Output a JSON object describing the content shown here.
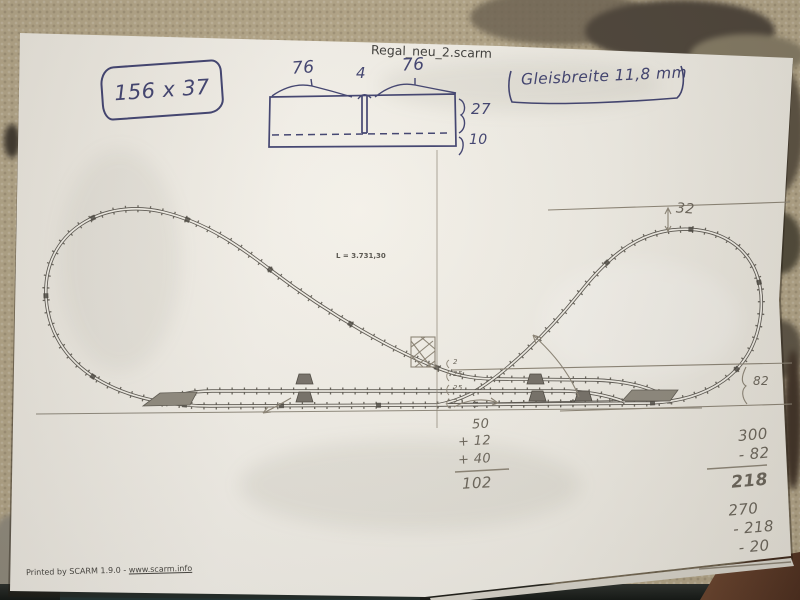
{
  "palette": {
    "ink": "#3e4170",
    "pencil": "#6b665c",
    "paper": "#f1efe8",
    "carpet": "#b2a588"
  },
  "paper": {
    "title": "Regal_neu_2.scarm",
    "footer": {
      "printed_by": "Printed by SCARM 1.9.0 - ",
      "url": "www.scarm.info"
    }
  },
  "plan": {
    "length_label": "L = 3.731,30"
  },
  "annotations": {
    "size_box": "156 x 37",
    "gauge_note": "Gleisbreite 11,8 mm",
    "shelf_diagram": {
      "left": "76",
      "middle": "4",
      "right": "76",
      "upper": "27",
      "lower": "10"
    },
    "dim_top": "32",
    "dim_right": "82",
    "spacings": [
      "2",
      "25",
      "25",
      "2"
    ],
    "center_sum": {
      "rows": [
        "50",
        "+ 12",
        "+ 40"
      ],
      "total": "102"
    },
    "right_calc_1": {
      "rows": [
        "300",
        "- 82"
      ],
      "result": "218"
    },
    "right_calc_2": {
      "rows": [
        "270",
        "- 218",
        "- 20"
      ]
    }
  }
}
